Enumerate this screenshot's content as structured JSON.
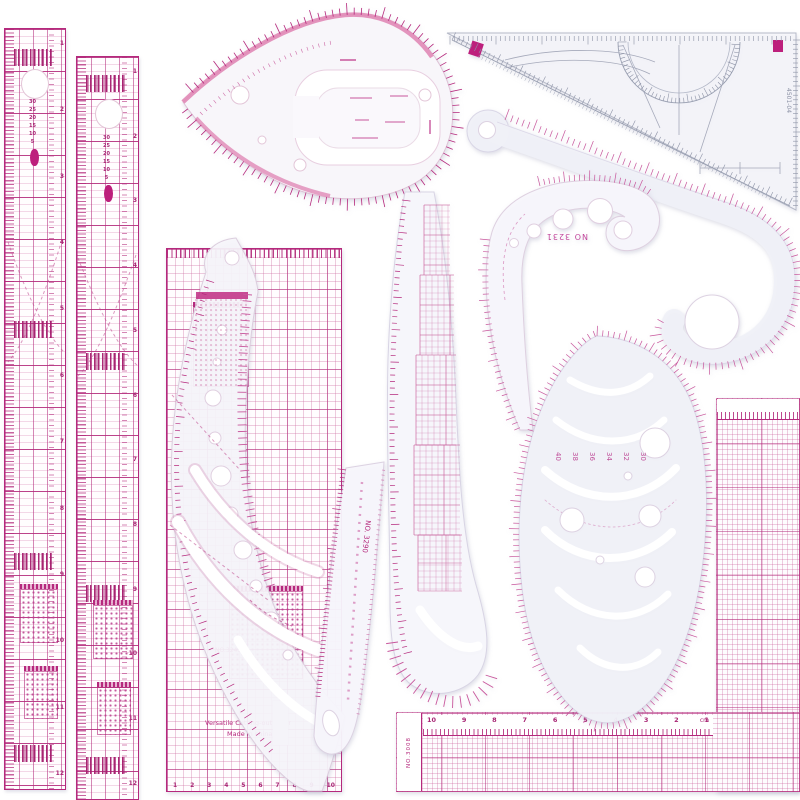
{
  "colors": {
    "accent": "#b5297d",
    "accent_mid": "#c8569c",
    "accent_light": "#e6a9cc",
    "body_tint": "#f1f1f8",
    "gray_line": "#a6aabb",
    "background": "#ffffff"
  },
  "labels": {
    "curve_no_3231": "NO 3231",
    "ruler_no_3290": "NO. 3290",
    "rect_no": "NO.3245",
    "versatile_line1": "Versatile Cutting-out Ruler",
    "versatile_line2": "Made in china",
    "lsquare_no": "NO.3008",
    "triangle_code": "4501-04",
    "cm_label": "cm"
  },
  "scales": {
    "left_ruler_numbers": [
      "1",
      "2",
      "3",
      "4",
      "5",
      "6",
      "7",
      "8",
      "9",
      "10",
      "11",
      "12"
    ],
    "spine_numbers": [
      "30",
      "25",
      "20",
      "15",
      "10",
      "5"
    ],
    "rect_bottom_numbers": [
      "1",
      "2",
      "3",
      "4",
      "5",
      "6",
      "7",
      "8",
      "9",
      "10"
    ],
    "bottom_cm_numbers": [
      "10",
      "9",
      "8",
      "7",
      "6",
      "5",
      "4",
      "3",
      "2",
      "1"
    ]
  },
  "egg_sizes": [
    "40",
    "38",
    "36",
    "34",
    "32",
    "30"
  ]
}
